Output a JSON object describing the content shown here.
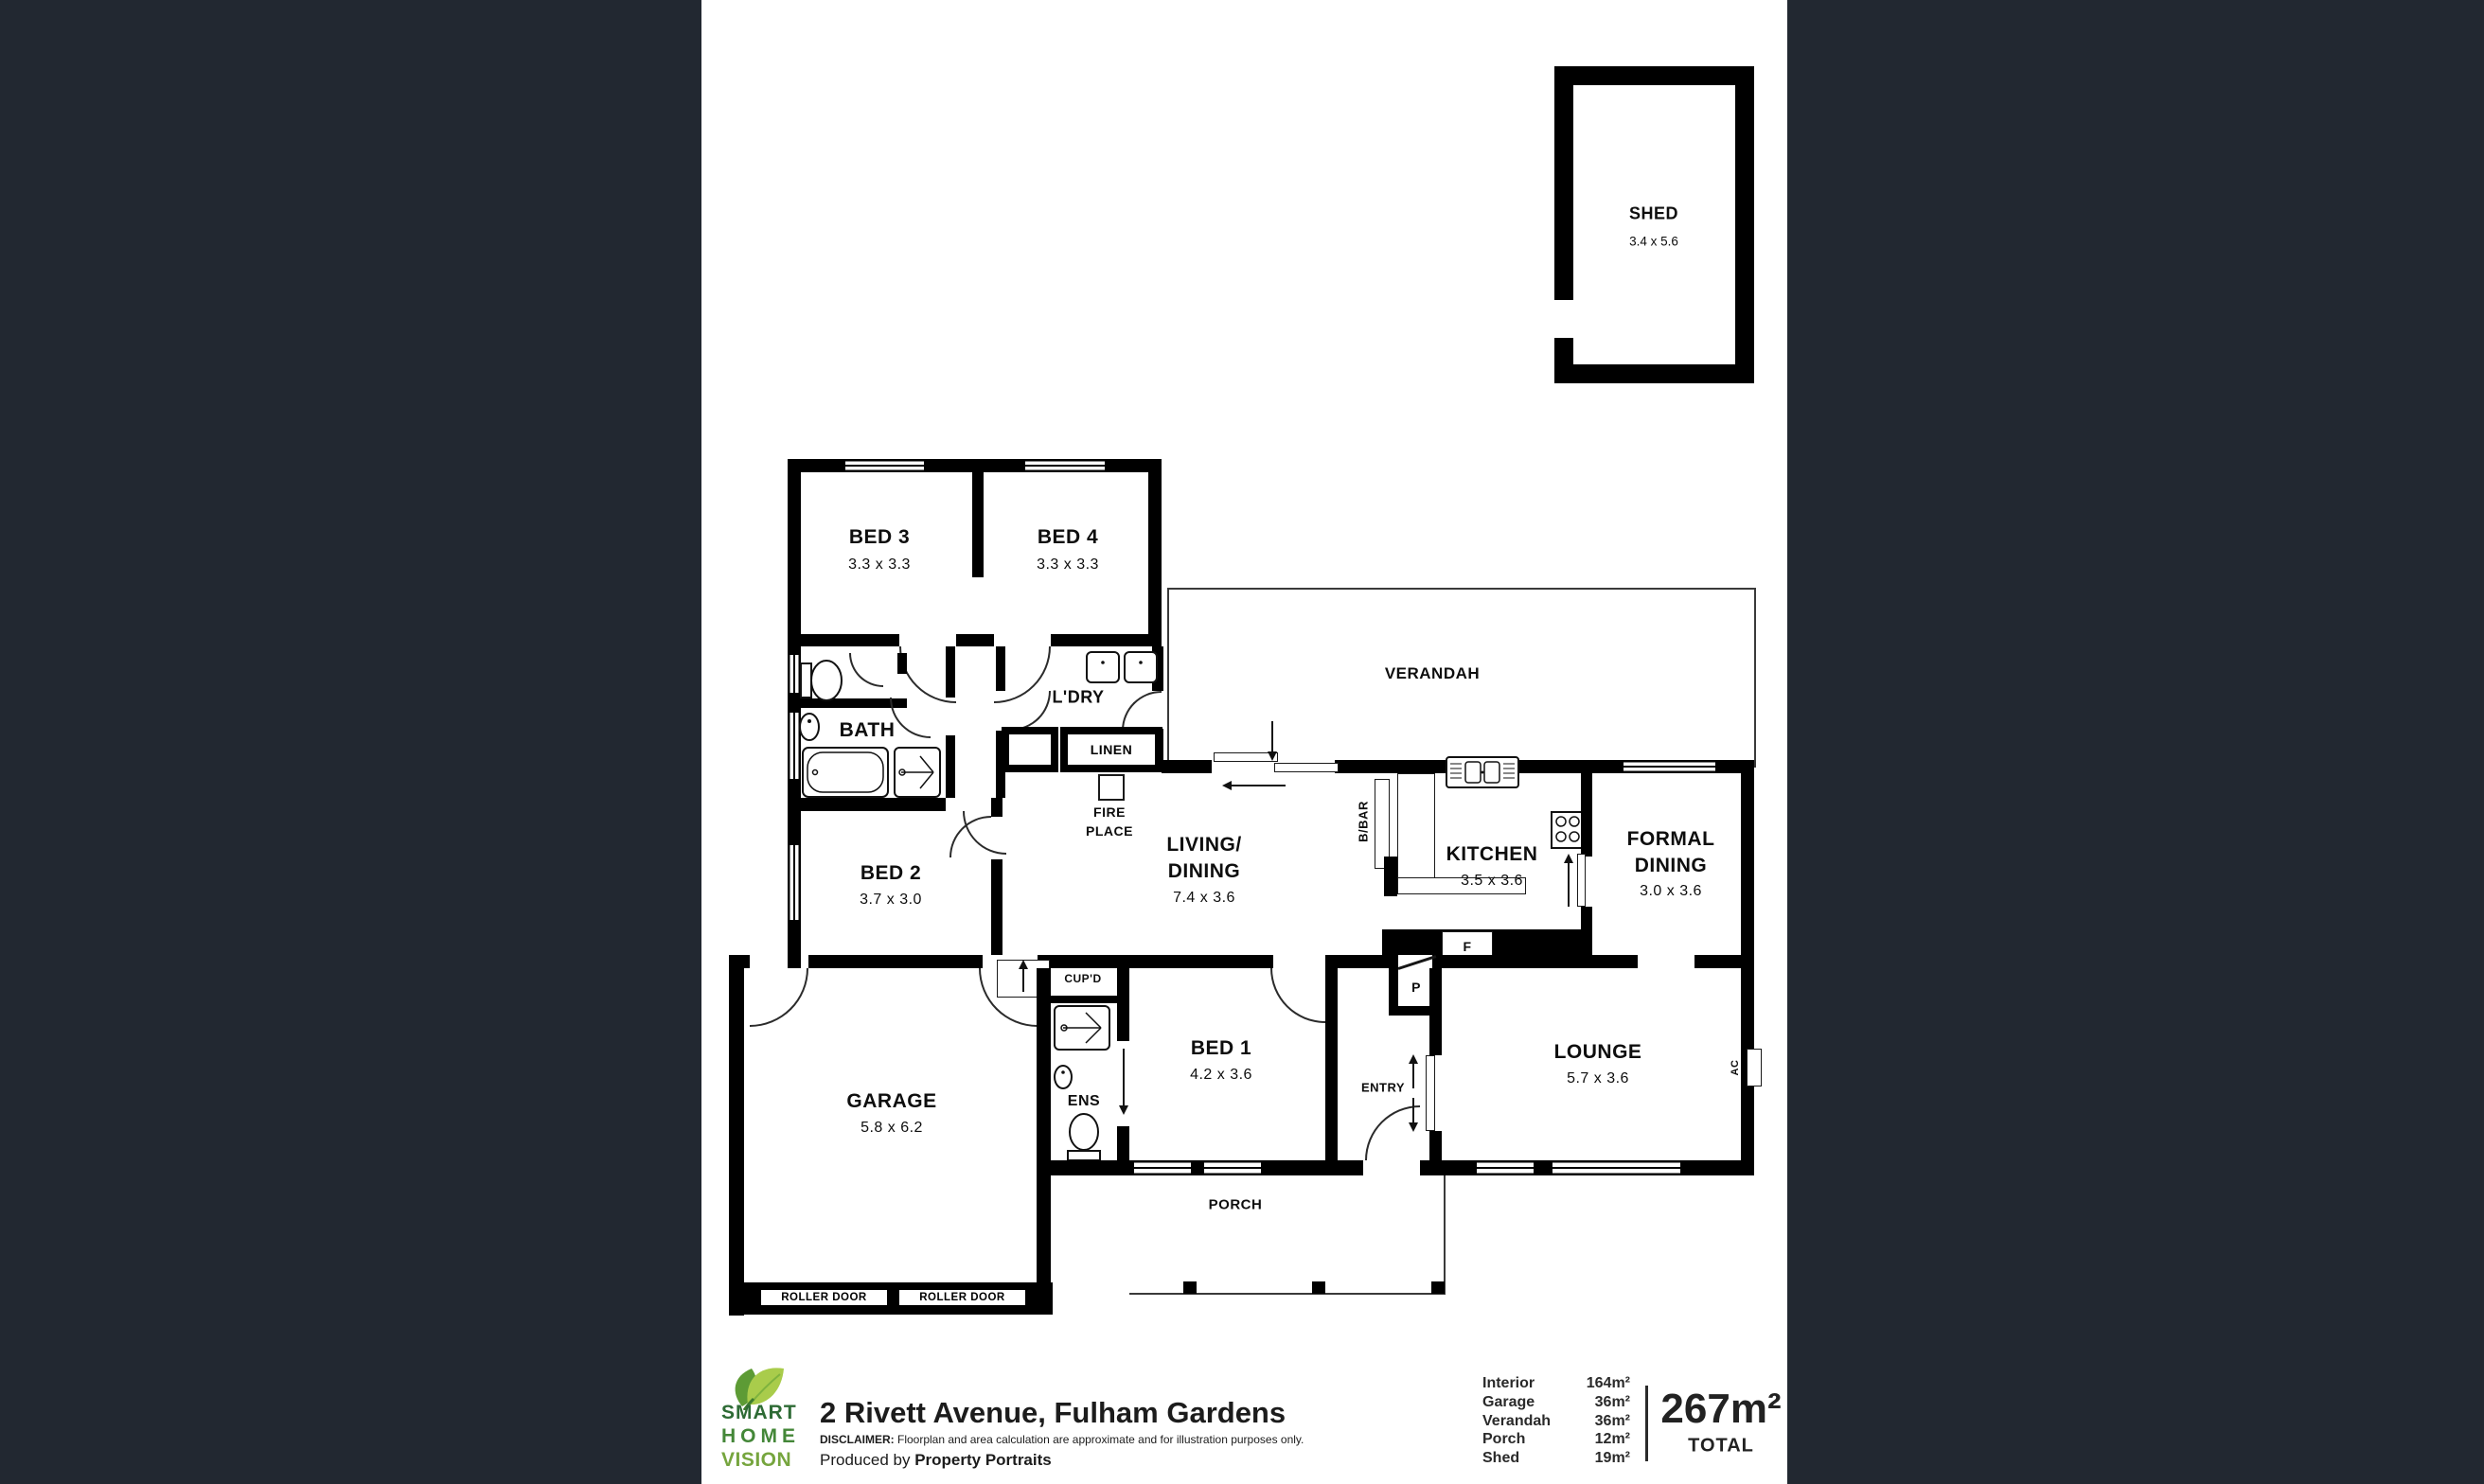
{
  "colors": {
    "background": "#222831",
    "plan_bg": "#ffffff",
    "wall": "#000000",
    "logo_smart": "#2e6b35",
    "logo_home": "#448738",
    "logo_vision": "#76a53e",
    "leaf_light": "#a9cc4b",
    "leaf_dark": "#5d9b35"
  },
  "rooms": {
    "shed": {
      "name": "SHED",
      "dims": "3.4 x 5.6"
    },
    "bed3": {
      "name": "BED 3",
      "dims": "3.3 x 3.3"
    },
    "bed4": {
      "name": "BED 4",
      "dims": "3.3 x 3.3"
    },
    "verandah": {
      "name": "VERANDAH"
    },
    "bath": {
      "name": "BATH"
    },
    "ldry": {
      "name": "L'DRY"
    },
    "linen": {
      "name": "LINEN"
    },
    "fireplace": {
      "line1": "FIRE",
      "line2": "PLACE"
    },
    "living": {
      "line1": "LIVING/",
      "line2": "DINING",
      "dims": "7.4 x 3.6"
    },
    "kitchen": {
      "name": "KITCHEN",
      "dims": "3.5 x 3.6"
    },
    "formal": {
      "line1": "FORMAL",
      "line2": "DINING",
      "dims": "3.0 x 3.6"
    },
    "bed2": {
      "name": "BED 2",
      "dims": "3.7 x 3.0"
    },
    "garage": {
      "name": "GARAGE",
      "dims": "5.8 x 6.2"
    },
    "ens": {
      "name": "ENS"
    },
    "cupd": {
      "name": "CUP'D"
    },
    "bed1": {
      "name": "BED 1",
      "dims": "4.2 x 3.6"
    },
    "entry": {
      "name": "ENTRY"
    },
    "lounge": {
      "name": "LOUNGE",
      "dims": "5.7 x 3.6"
    },
    "porch": {
      "name": "PORCH"
    },
    "bbar": {
      "name": "B/BAR"
    },
    "fridge": {
      "name": "F"
    },
    "pantry": {
      "name": "P"
    },
    "ac": {
      "name": "AC"
    },
    "roller_door": {
      "name": "ROLLER DOOR"
    }
  },
  "footer": {
    "logo": {
      "line1": "SMART",
      "line2": "HOME",
      "line3": "VISION"
    },
    "address": "2 Rivett Avenue, Fulham Gardens",
    "disclaimer_label": "DISCLAIMER:",
    "disclaimer_text": " Floorplan and area calculation are approximate and for illustration purposes only.",
    "produced_prefix": "Produced by ",
    "produced_name": "Property Portraits",
    "areas": [
      {
        "label": "Interior",
        "value": "164m²"
      },
      {
        "label": "Garage",
        "value": "36m²"
      },
      {
        "label": "Verandah",
        "value": "36m²"
      },
      {
        "label": "Porch",
        "value": "12m²"
      },
      {
        "label": "Shed",
        "value": "19m²"
      }
    ],
    "total_value": "267m²",
    "total_label": "TOTAL"
  }
}
